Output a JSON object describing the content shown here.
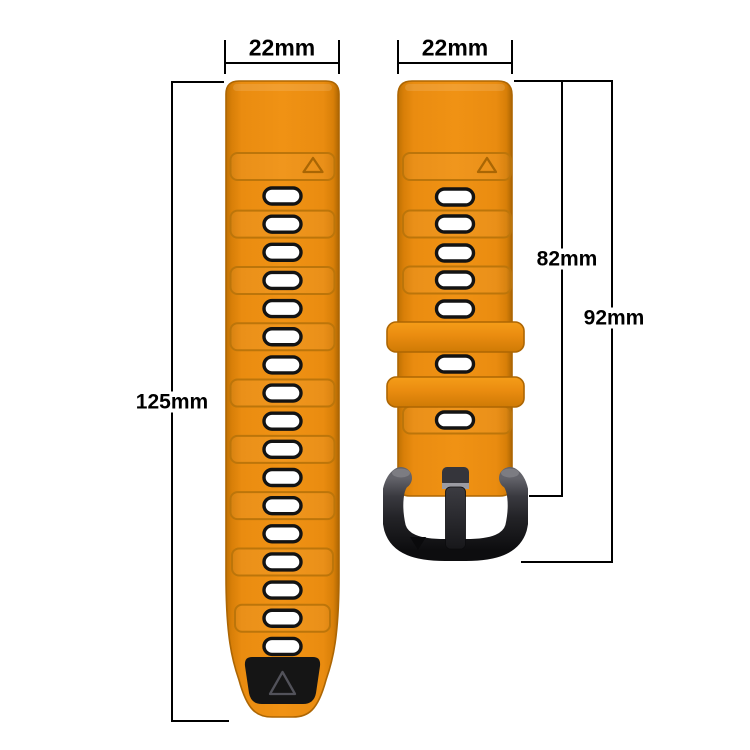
{
  "page": {
    "background": "#ffffff",
    "kind": "watch-strap-dimension-diagram"
  },
  "dimension_labels": {
    "left_strap_width": "22mm",
    "right_strap_width": "22mm",
    "left_strap_length": "125mm",
    "right_strap_length": "82mm",
    "right_total_length": "92mm"
  },
  "straps": {
    "left": {
      "hole_count": 17,
      "panel_hole_indices": [
        1,
        3,
        5,
        7,
        9,
        11,
        13,
        15
      ],
      "has_black_tip": true,
      "triangle_marker_count": 2
    },
    "right": {
      "hole_centers_y": [
        117,
        144,
        173,
        200,
        229,
        284,
        340
      ],
      "panel_centers_y": [
        144,
        200,
        340
      ],
      "keeper_tops_y": [
        242,
        297
      ],
      "has_buckle": true,
      "triangle_marker_count": 2
    }
  },
  "colors": {
    "strap_orange": "#ea8c10",
    "strap_orange_light": "#f09214",
    "strap_orange_dark": "#d87f08",
    "strap_orange_edge": "#ad6603",
    "panel_outline": "#bc750a",
    "triangle_outline": "#a96604",
    "hole_fill": "#ffffff",
    "hole_outline": "#131313",
    "tip_black": "#151515",
    "tip_triangle": "#52525a",
    "buckle_light": "#63636a",
    "buckle_mid": "#232327",
    "buckle_dark": "#0d0d0f",
    "tang_highlight": "#9b9ba2",
    "dimension_line": "#000000",
    "label_text": "#000000"
  }
}
